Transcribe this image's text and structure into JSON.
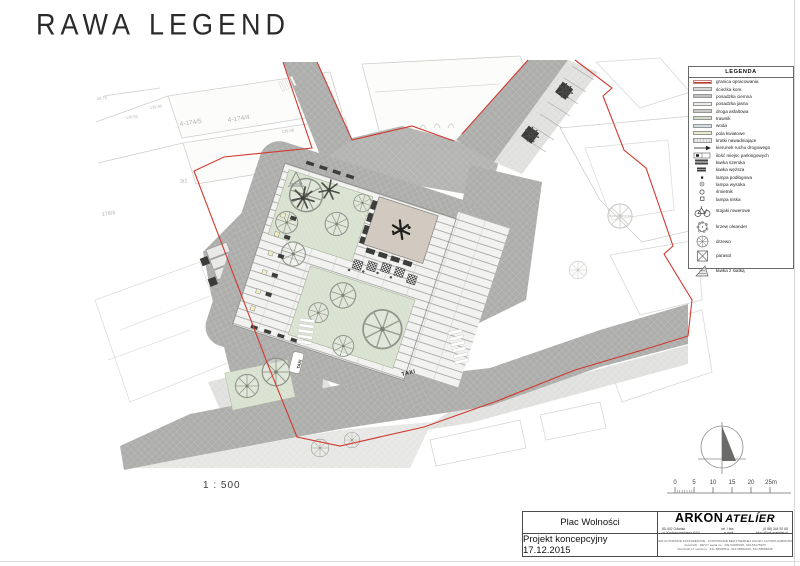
{
  "logo": {
    "title_word1": "RAWA",
    "title_word2": "LEGEND"
  },
  "plan": {
    "scale_label": "1 : 500",
    "labels": {
      "parcel_a": "4-174/5",
      "parcel_b": "4-174/4",
      "parcel_c": "3/2",
      "parcel_d": "178/6",
      "elev_a": "26,78",
      "elev_b": "139,40",
      "elev_c": "139,52",
      "elev_d": "139,98",
      "taxi_road": "TAXI",
      "taxi_bay": "TAXI"
    }
  },
  "legend": {
    "title": "LEGENDA",
    "items": [
      {
        "label": "granica opracowania"
      },
      {
        "label": "ścieżka kom."
      },
      {
        "label": "posadzka ciemna"
      },
      {
        "label": "posadzka jasna"
      },
      {
        "label": "droga asfaltowa"
      },
      {
        "label": "trawnik"
      },
      {
        "label": "woda"
      },
      {
        "label": "pola kwiatowe"
      },
      {
        "label": "kratki nawadniające"
      },
      {
        "label": "kierunek ruchu drogowego"
      },
      {
        "label": "ilość miejsc parkingowych"
      },
      {
        "label": "ławka szeroka"
      },
      {
        "label": "ławka węższa"
      },
      {
        "label": "lampa podłogowa"
      },
      {
        "label": "lampa wysoka"
      },
      {
        "label": "śmietnik"
      },
      {
        "label": "lampa niska"
      },
      {
        "label": "stojaki rowerowe"
      },
      {
        "label": "krzew oleander"
      },
      {
        "label": "drzewo"
      },
      {
        "label": "parasol"
      },
      {
        "label": "ławka z siatką"
      }
    ]
  },
  "scale_bar": {
    "ticks": [
      "0",
      "5",
      "10",
      "15",
      "20",
      "25m"
    ]
  },
  "title_block": {
    "project": "Plac Wolności",
    "stage": "Projekt koncepcyjny 17.12.2015",
    "firm_name_bold": "ARKON",
    "firm_name_light": "ATELÍER",
    "address_line1": "80-402 Gdańsk",
    "address_line2": "ul. Kochanowskiego 64/4",
    "tel_label": "tel. / fax:",
    "tel_value": "(0 58) 344 92 65",
    "email_label": "e-mail:",
    "email_value": "biuro@arkonatelier.pl",
    "copyright_line1": "PRAWA AUTORSKIE ZASTRZEŻONE - KOPIOWANIE BEZ PISEMNEJ ZGODY AUTORA ZABRONIONE",
    "copyright_line2": "AutoCAD - REVIT serial no.: 349-54455290, 349-53175979",
    "copyright_line3": "AutoCAD LT serial no.: 341-58590511, 341-58590429, 341-58588230"
  },
  "colors": {
    "boundary_red": "#cf3a30",
    "road_dark": "#adadab",
    "pavement_light": "#e4e4e2",
    "square_base": "#f2f2f0",
    "lawn_green": "#dbe3d3",
    "plaza_beige": "#d2cac1",
    "water_blue": "#cfdfe9",
    "flower_yellow": "#ebebcb"
  }
}
